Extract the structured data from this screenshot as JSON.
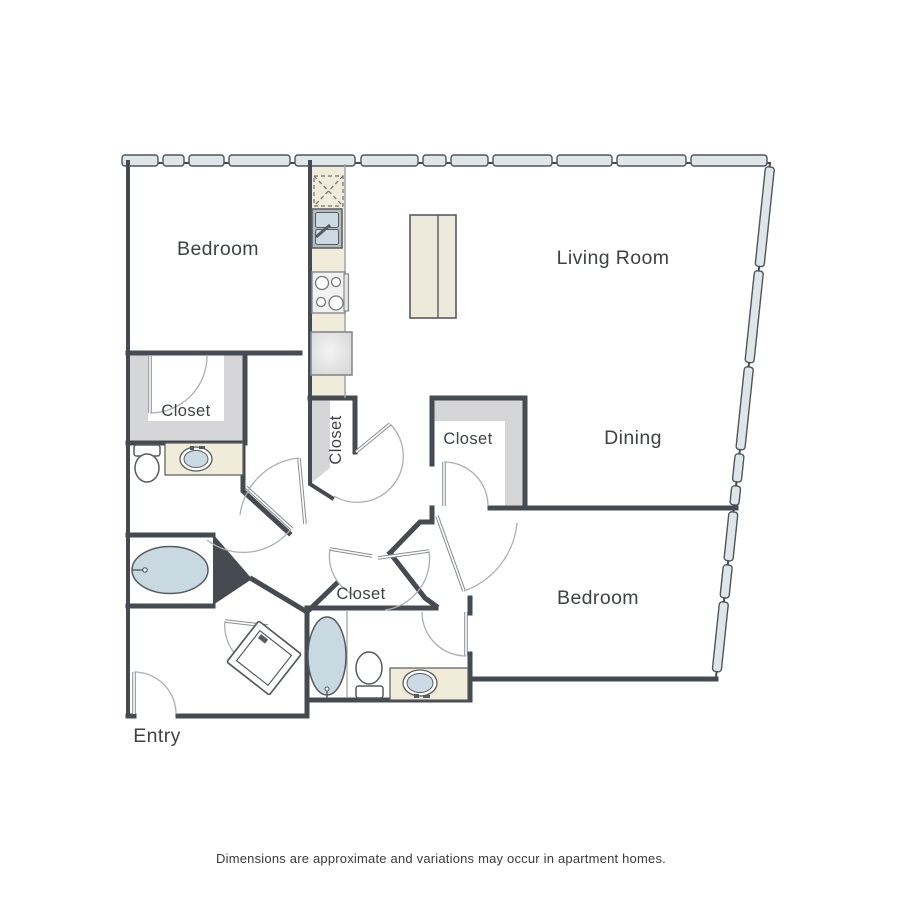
{
  "page": {
    "footer_note": "Dimensions are approximate and variations may occur in apartment homes."
  },
  "floor_plan": {
    "rooms": {
      "bedroom_upper": {
        "label": "Bedroom"
      },
      "living_room": {
        "label": "Living Room"
      },
      "dining": {
        "label": "Dining"
      },
      "bedroom_lower": {
        "label": "Bedroom"
      },
      "entry": {
        "label": "Entry"
      },
      "closet_master": {
        "label": "Closet"
      },
      "closet_hall": {
        "label": "Closet"
      },
      "closet_dining": {
        "label": "Closet"
      },
      "closet_bath": {
        "label": "Closet"
      }
    },
    "fixtures": [
      "pantry-dashed-box",
      "kitchen-double-sink",
      "range-stove",
      "refrigerator",
      "kitchen-island",
      "toilet",
      "vanity-sink",
      "bathtub",
      "washer-dryer",
      "toilet-2",
      "vanity-sink-2",
      "bathtub-2"
    ],
    "colors": {
      "wall": "#464b51",
      "window_fill": "#dfe6ea",
      "counter_fill": "#f0ecd9",
      "closet_fill": "#d6d6d8",
      "fixture_fill": "#c9d9e1",
      "label": "#3f4245"
    }
  }
}
